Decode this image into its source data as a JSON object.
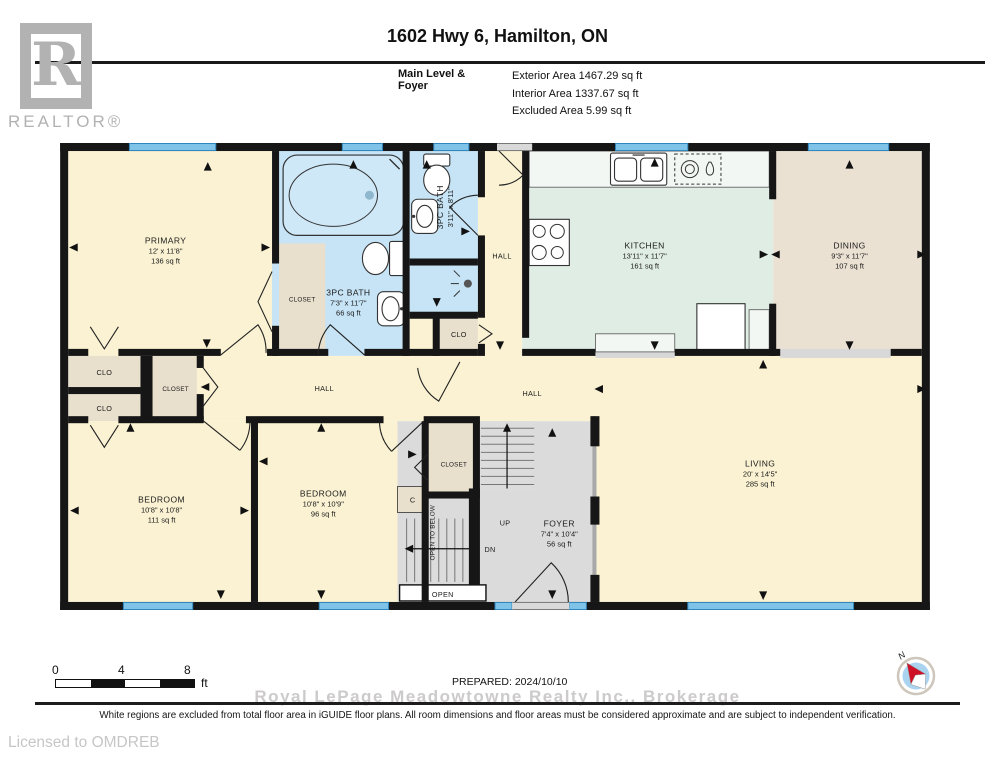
{
  "header": {
    "logo_letter": "R",
    "logo_word": "REALTOR®",
    "title": "1602 Hwy 6, Hamilton, ON",
    "level_label": "Main Level & Foyer",
    "area_lines": [
      "Exterior Area 1467.29 sq ft",
      "Interior Area 1337.67 sq ft",
      "Excluded Area 5.99 sq ft"
    ]
  },
  "plan": {
    "rooms": {
      "primary": {
        "name": "PRIMARY",
        "dims": "12' x 11'8\"",
        "area": "136 sq ft"
      },
      "bath_main": {
        "name": "3PC BATH",
        "dims": "7'3\" x 11'7\"",
        "area": "66 sq ft"
      },
      "bath_small": {
        "name": "3PC BATH",
        "dims": "3'11\" x 8'11\""
      },
      "kitchen": {
        "name": "KITCHEN",
        "dims": "13'11\" x 11'7\"",
        "area": "161 sq ft"
      },
      "dining": {
        "name": "DINING",
        "dims": "9'3\" x 11'7\"",
        "area": "107 sq ft"
      },
      "living": {
        "name": "LIVING",
        "dims": "20' x 14'5\"",
        "area": "285 sq ft"
      },
      "bedroom1": {
        "name": "BEDROOM",
        "dims": "10'8\" x 10'8\"",
        "area": "111 sq ft"
      },
      "bedroom2": {
        "name": "BEDROOM",
        "dims": "10'8\" x 10'9\"",
        "area": "96 sq ft"
      },
      "foyer": {
        "name": "FOYER",
        "dims": "7'4\" x 10'4\"",
        "area": "56 sq ft"
      }
    },
    "labels": {
      "hall": "HALL",
      "closet": "CLOSET",
      "clo": "CLO",
      "c": "C",
      "up": "UP",
      "dn": "DN",
      "open": "OPEN",
      "open_to_below": "OPEN TO BELOW"
    }
  },
  "scale_bar": {
    "tick0": "0",
    "tick4": "4",
    "tick8": "8",
    "unit": "ft"
  },
  "footer": {
    "prepared": "PREPARED: 2024/10/10",
    "watermark": "Royal LePage Meadowtowne Realty Inc.,  Brokerage",
    "disclaimer": "White regions are excluded from total floor area in iGUIDE floor plans. All room dimensions and floor areas must be considered approximate and are subject to independent verification.",
    "licensed_to": "Licensed to OMDREB",
    "compass_north": "N"
  },
  "colors": {
    "room_cream": "#FAF2D2",
    "room_blue": "#C6E4F5",
    "room_mint": "#E0EDE4",
    "room_tan": "#EAE1D3",
    "closet_beige": "#E8DFCC",
    "floor_gray": "#DBDBDB",
    "window_blue": "#58ABDB",
    "wall_black": "#161616"
  }
}
